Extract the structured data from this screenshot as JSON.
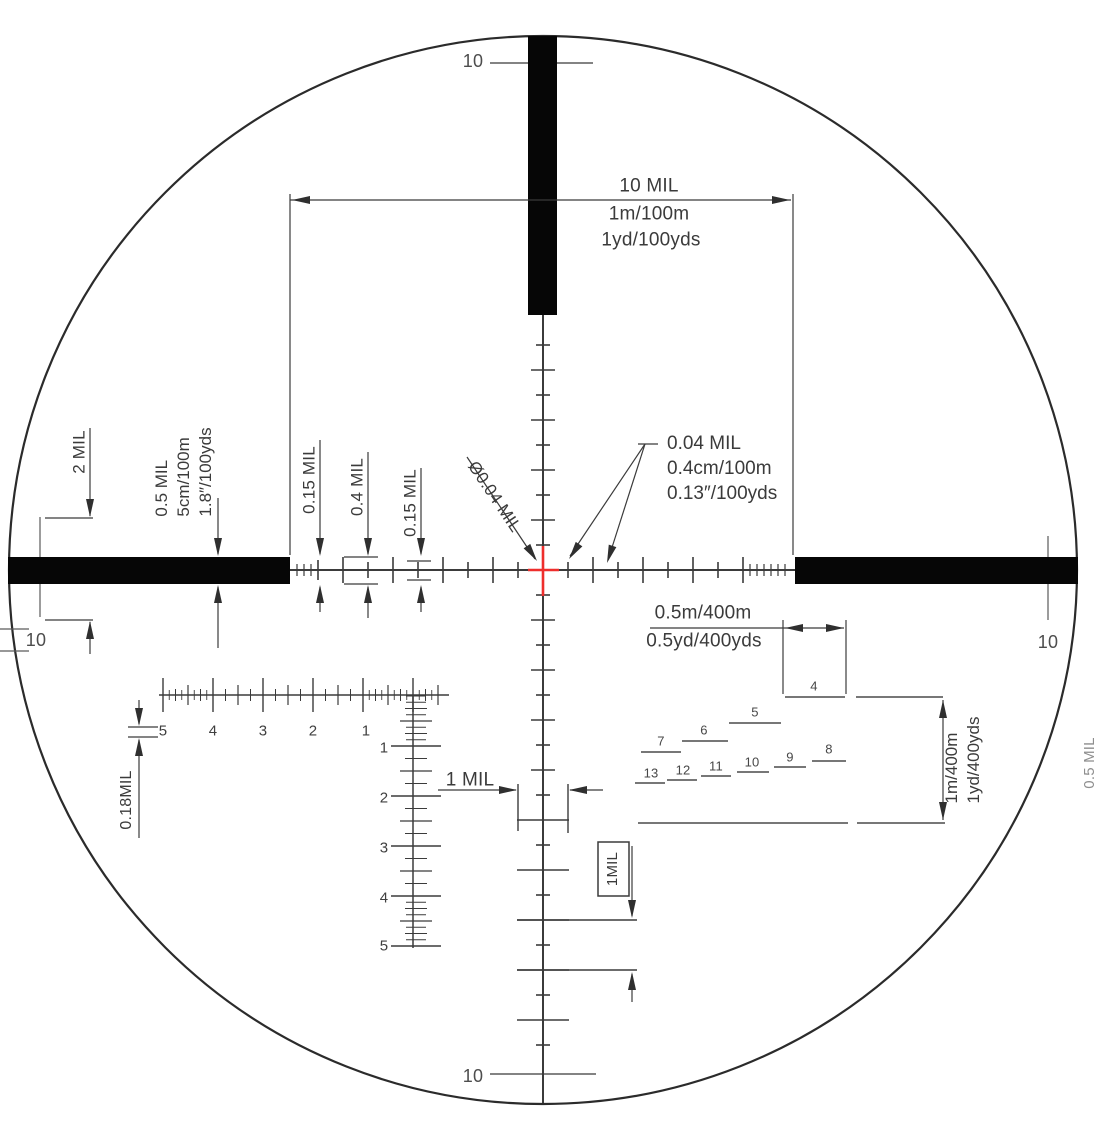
{
  "diagram": {
    "edge_marks": {
      "top": "10",
      "bottom": "10",
      "left": "10",
      "right": "10"
    },
    "annotations": {
      "ten_mil": {
        "title": "10 MIL",
        "metric": "1m/100m",
        "imperial": "1yd/100yds"
      },
      "two_mil": "2 MIL",
      "half_mil": {
        "title": "0.5 MIL",
        "metric": "5cm/100m",
        "imperial": "1.8″/100yds"
      },
      "tick_left_outer": "0.15 MIL",
      "tick_left_mid": "0.4 MIL",
      "tick_left_inner": "0.15 MIL",
      "center_dot_diameter": "Ø0.04 MIL",
      "center_dot": {
        "title": "0.04 MIL",
        "metric": "0.4cm/100m",
        "imperial": "0.13″/100yds"
      },
      "bracket_half_m": {
        "metric": "0.5m/400m",
        "imperial": "0.5yd/400yds"
      },
      "bracket_one_m": {
        "metric": "1m/400m",
        "imperial": "1yd/400yds"
      },
      "scale_tick": "0.18MIL",
      "one_mil": "1 MIL",
      "one_mil_boxed": "1MIL",
      "edge_note": "0.5 MIL"
    },
    "rangefinder_numbers": [
      "4",
      "5",
      "6",
      "7",
      "8",
      "9",
      "10",
      "11",
      "12",
      "13"
    ],
    "mil_scale": {
      "horizontal": [
        "5",
        "4",
        "3",
        "2",
        "1"
      ],
      "vertical": [
        "1",
        "2",
        "3",
        "4",
        "5"
      ]
    },
    "colors": {
      "ink": "#3b3b3b",
      "post": "#060606",
      "center_cross": "#ee2e2c",
      "muted": "#6e6e6e"
    }
  }
}
